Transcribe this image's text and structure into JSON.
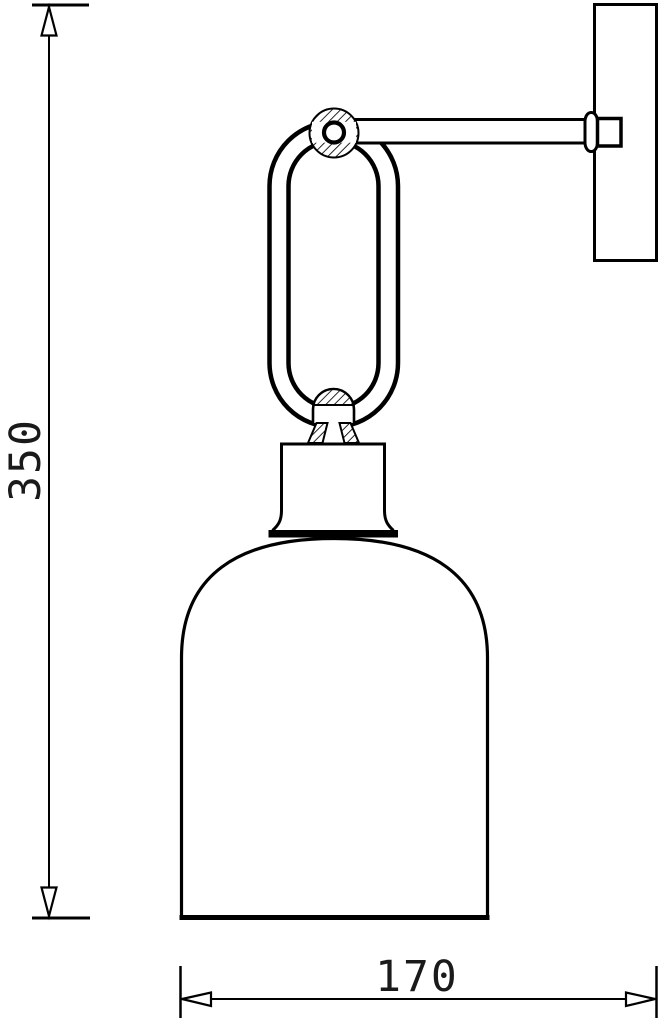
{
  "drawing": {
    "background_color": "#ffffff",
    "line_color": "#000000",
    "dimensions": {
      "height": {
        "value": "350"
      },
      "depth": {
        "value": "170"
      }
    }
  }
}
